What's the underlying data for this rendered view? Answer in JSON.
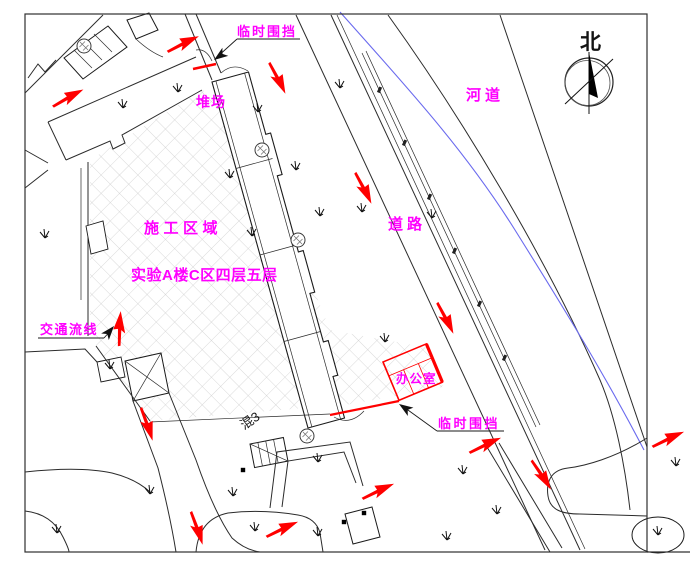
{
  "labels": {
    "north": "北",
    "river": "河道",
    "road": "道路",
    "construction_area": "施工区域",
    "work_zone": "实验A楼C区四层五层",
    "traffic_flow": "交通流线",
    "office": "办公室",
    "temp_fence_top": "临时围挡",
    "temp_fence_bottom": "临时围挡",
    "stack_yard": "堆场",
    "concrete_mix": "混3"
  },
  "colors": {
    "annotation": "#FF00FF",
    "flow": "#FF0000",
    "fence": "#FF0000",
    "water": "#6A6AEE",
    "line": "#1A1A1A",
    "hatch": "#CBCBCB"
  },
  "icons": {
    "compass": "north-compass-icon",
    "grass": "grass-icon",
    "tree": "tree-icon",
    "flow_arrow": "flow-arrow-icon",
    "leader_arrow": "leader-arrowhead-icon"
  }
}
